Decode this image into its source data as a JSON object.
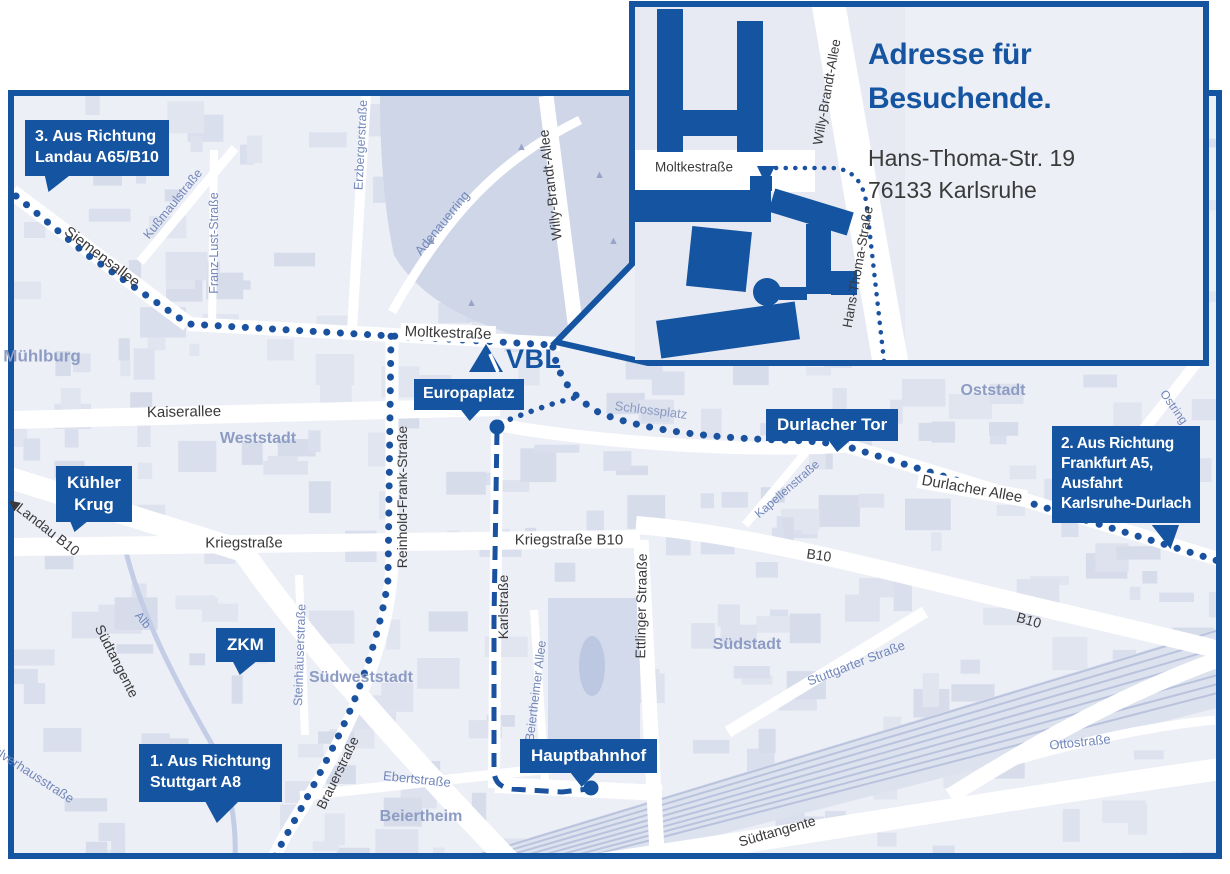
{
  "colors": {
    "brand_blue": "#1554a0",
    "map_bg": "#edeff6",
    "route_blue": "#1a52a0"
  },
  "logo": {
    "text": "VBL"
  },
  "inset": {
    "title_line1": "Adresse für",
    "title_line2": "Besuchende.",
    "address_line1": "Hans-Thoma-Str. 19",
    "address_line2": "76133 Karlsruhe",
    "street_moltkestrasse": "Moltkestraße",
    "street_willy_brandt_allee": "Willy-Brandt-Allee",
    "street_hans_thoma_strasse": "Hans-Thoma-Straße"
  },
  "callouts": {
    "route3_line1": "3. Aus Richtung",
    "route3_line2": "Landau A65/B10",
    "route2_line1": "2. Aus Richtung",
    "route2_line2": "Frankfurt A5,",
    "route2_line3": "Ausfahrt",
    "route2_line4": "Karlsruhe-Durlach",
    "route1_line1": "1. Aus Richtung",
    "route1_line2": "Stuttgart A8",
    "kuehler_krug_line1": "Kühler",
    "kuehler_krug_line2": "Krug",
    "zkm": "ZKM",
    "europaplatz": "Europaplatz",
    "durlacher_tor": "Durlacher Tor",
    "hauptbahnhof": "Hauptbahnhof"
  },
  "districts": {
    "muehlburg": "Mühlburg",
    "weststadt": "Weststadt",
    "oststadt": "Oststadt",
    "suedweststadt": "Südweststadt",
    "suedstadt": "Südstadt",
    "beiertheim": "Beiertheim"
  },
  "streets": {
    "siemensallee": "Siemensallee",
    "kussmaulstrasse": "Kußmaulstraße",
    "franz_lust_strasse": "Franz-Lust-Straße",
    "erzbergerstrasse": "Erzbergerstraße",
    "adenauerring": "Adenauerring",
    "willy_brandt_allee": "Willy-Brandt-Allee",
    "moltkestrasse": "Moltkestraße",
    "kaiserallee": "Kaiserallee",
    "schlossplatz": "Schlossplatz",
    "durlacher_allee": "Durlacher Allee",
    "kapellenstrasse": "Kapellenstraße",
    "ostring": "Ostring",
    "b10": "B10",
    "kriegstrasse": "Kriegstraße",
    "kriegstrasse_b10": "Kriegstraße B10",
    "karlstrasse": "Karlstraße",
    "ettlinger_strasse": "Ettlinger Straaße",
    "reinhold_frank_strasse": "Reinhold-Frank-Straße",
    "steinhaeuserstrasse": "Steinhäuserstraße",
    "beiertheimer_allee": "Beiertheimer Allee",
    "brauerstrasse": "Brauerstraße",
    "ebertstrasse": "Ebertstraße",
    "suedtangente": "Südtangente",
    "alb": "Alb",
    "landau_arrow": "◀",
    "landau_b10": "Landau B10",
    "pulverhausstrasse": "Pulverhausstraße",
    "stuttgarter_strasse": "Stuttgarter Straße",
    "ottostrasse": "Ottostraße"
  }
}
